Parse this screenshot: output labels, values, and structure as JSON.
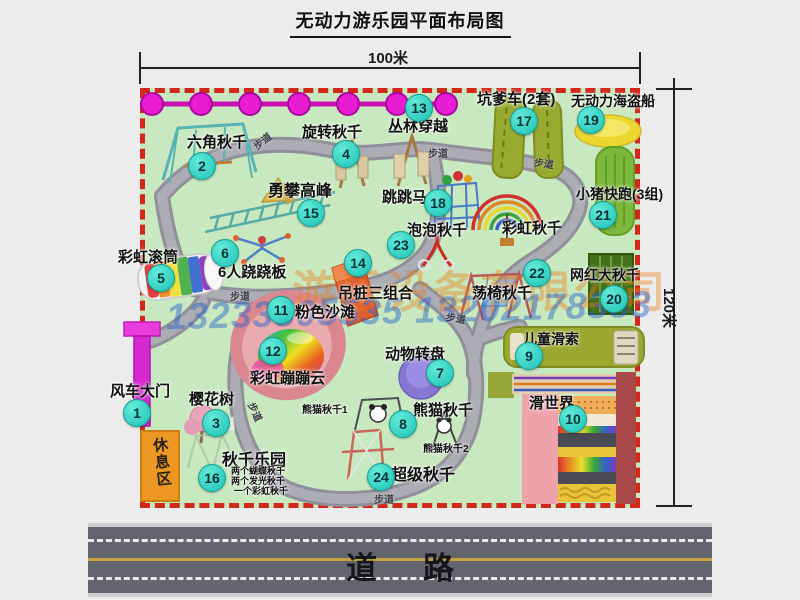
{
  "title": "无动力游乐园平面布局图",
  "dimensions": {
    "width_label": "100米",
    "height_label": "120米"
  },
  "road": {
    "label": "道路"
  },
  "watermark": {
    "company": "游乐设备有限公司",
    "phone": "13233805535 13202178333"
  },
  "map": {
    "rest_area": "休息区",
    "markers": [
      {
        "n": "1",
        "label": "风车大门",
        "bx": 136,
        "by": 412,
        "lx": 110,
        "ly": 380,
        "ls": 15
      },
      {
        "n": "2",
        "label": "六角秋千",
        "bx": 201,
        "by": 165,
        "lx": 187,
        "ly": 131,
        "ls": 15
      },
      {
        "n": "3",
        "label": "樱花树",
        "bx": 215,
        "by": 422,
        "lx": 189,
        "ly": 388,
        "ls": 15
      },
      {
        "n": "4",
        "label": "旋转秋千",
        "bx": 345,
        "by": 153,
        "lx": 302,
        "ly": 121,
        "ls": 15
      },
      {
        "n": "5",
        "label": "彩虹滚筒",
        "bx": 160,
        "by": 277,
        "lx": 118,
        "ly": 246,
        "ls": 15
      },
      {
        "n": "6",
        "label": "6人跷跷板",
        "bx": 224,
        "by": 252,
        "lx": 218,
        "ly": 261,
        "ls": 15
      },
      {
        "n": "7",
        "label": "动物转盘",
        "bx": 439,
        "by": 372,
        "lx": 385,
        "ly": 343,
        "ls": 15
      },
      {
        "n": "8",
        "label": "熊猫秋千",
        "bx": 402,
        "by": 423,
        "lx": 413,
        "ly": 399,
        "ls": 15
      },
      {
        "n": "9",
        "label": "儿童滑索",
        "bx": 528,
        "by": 355,
        "lx": 523,
        "ly": 329,
        "ls": 14
      },
      {
        "n": "10",
        "label": "滑世界",
        "bx": 572,
        "by": 418,
        "lx": 529,
        "ly": 392,
        "ls": 15
      },
      {
        "n": "11",
        "label": "粉色沙滩",
        "bx": 280,
        "by": 309,
        "lx": 295,
        "ly": 301,
        "ls": 15
      },
      {
        "n": "12",
        "label": "彩虹蹦蹦云",
        "bx": 272,
        "by": 350,
        "lx": 250,
        "ly": 367,
        "ls": 15
      },
      {
        "n": "13",
        "label": "丛林穿越",
        "bx": 418,
        "by": 107,
        "lx": 388,
        "ly": 115,
        "ls": 15
      },
      {
        "n": "14",
        "label": "吊桩三组合",
        "bx": 357,
        "by": 262,
        "lx": 338,
        "ly": 282,
        "ls": 15
      },
      {
        "n": "15",
        "label": "勇攀高峰",
        "bx": 310,
        "by": 212,
        "lx": 268,
        "ly": 177,
        "ls": 16
      },
      {
        "n": "16",
        "label": "秋千乐园",
        "bx": 211,
        "by": 477,
        "lx": 222,
        "ly": 446,
        "ls": 16
      },
      {
        "n": "17",
        "label": "坑爹车(2套)",
        "bx": 523,
        "by": 120,
        "lx": 477,
        "ly": 88,
        "ls": 15
      },
      {
        "n": "18",
        "label": "跳跳马",
        "bx": 437,
        "by": 202,
        "lx": 382,
        "ly": 186,
        "ls": 15
      },
      {
        "n": "19",
        "label": "无动力海盗船",
        "bx": 590,
        "by": 119,
        "lx": 571,
        "ly": 91,
        "ls": 14
      },
      {
        "n": "20",
        "label": "网红大秋千",
        "bx": 613,
        "by": 298,
        "lx": 570,
        "ly": 265,
        "ls": 14
      },
      {
        "n": "21",
        "label": "小猪快跑(3组)",
        "bx": 602,
        "by": 214,
        "lx": 576,
        "ly": 184,
        "ls": 14
      },
      {
        "n": "22",
        "label": "荡椅秋千",
        "bx": 536,
        "by": 272,
        "lx": 472,
        "ly": 282,
        "ls": 15
      },
      {
        "n": "23",
        "label": "泡泡秋千",
        "bx": 400,
        "by": 244,
        "lx": 407,
        "ly": 219,
        "ls": 15
      },
      {
        "n": "24",
        "label": "超级秋千",
        "bx": 380,
        "by": 476,
        "lx": 391,
        "ly": 461,
        "ls": 16
      }
    ],
    "extra_labels": [
      {
        "text": "彩虹秋千",
        "x": 502,
        "y": 217,
        "size": 15
      },
      {
        "text": "熊猫秋千1",
        "x": 302,
        "y": 401,
        "size": 10
      },
      {
        "text": "熊猫秋千2",
        "x": 423,
        "y": 440,
        "size": 10
      },
      {
        "text": "两个蝴蝶秋千",
        "x": 231,
        "y": 464,
        "size": 9
      },
      {
        "text": "两个发光秋千",
        "x": 231,
        "y": 474,
        "size": 9
      },
      {
        "text": "一个彩虹秋千",
        "x": 234,
        "y": 484,
        "size": 9
      }
    ],
    "path_labels": [
      {
        "text": "步道",
        "x": 252,
        "y": 133,
        "rot": -38
      },
      {
        "text": "步道",
        "x": 428,
        "y": 145,
        "rot": 0
      },
      {
        "text": "步道",
        "x": 534,
        "y": 155,
        "rot": 8
      },
      {
        "text": "步道",
        "x": 230,
        "y": 288,
        "rot": 0
      },
      {
        "text": "步道",
        "x": 246,
        "y": 404,
        "rot": 65
      },
      {
        "text": "步道",
        "x": 446,
        "y": 310,
        "rot": 10
      },
      {
        "text": "步道",
        "x": 374,
        "y": 491,
        "rot": 0
      }
    ]
  }
}
